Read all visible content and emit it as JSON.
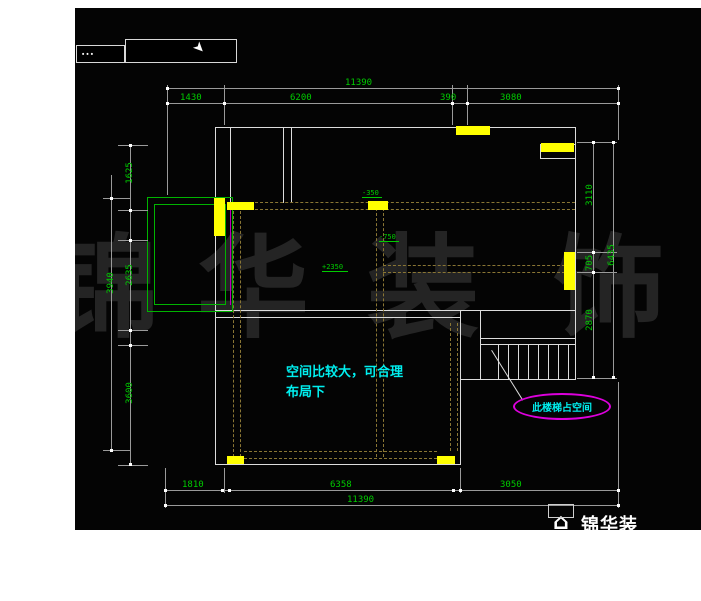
{
  "toolbar": {
    "box_marks": "∙∙∙"
  },
  "icons": {
    "cursor": "cursor-arrow",
    "logo": "house"
  },
  "watermark": {
    "chars": [
      "锦",
      "华",
      "装",
      "饰"
    ]
  },
  "brand": {
    "logo_text": "锦华装"
  },
  "plan": {
    "note_line1": "空间比较大，可合理",
    "note_line2": "布局下",
    "stair_callout": "此楼梯占空间",
    "elevation_marks": {
      "top": "-350",
      "mid": "-750",
      "low": "+2350"
    }
  },
  "dimensions": {
    "top": {
      "total": "11390",
      "seg1": "1430",
      "seg2": "6200",
      "seg3": "390",
      "seg4": "3080"
    },
    "bottom": {
      "seg1": "1810",
      "seg2": "6358",
      "seg3": "3050",
      "total": "11390"
    },
    "left": {
      "seg1": "1625",
      "seg2": "2635",
      "seg3": "3600",
      "outer": "3940"
    },
    "right": {
      "seg1": "3110",
      "seg2": "705",
      "seg3": "2870",
      "outer": "6435"
    }
  },
  "colors": {
    "dimension_text": "#00cc00",
    "note_cyan": "#00ffff",
    "highlight_yellow": "#ffff00",
    "callout_magenta": "#dd00dd",
    "balcony_green": "#00b400",
    "layout_dash_olive": "#8a7634",
    "wall_white": "#dcdcdc"
  }
}
